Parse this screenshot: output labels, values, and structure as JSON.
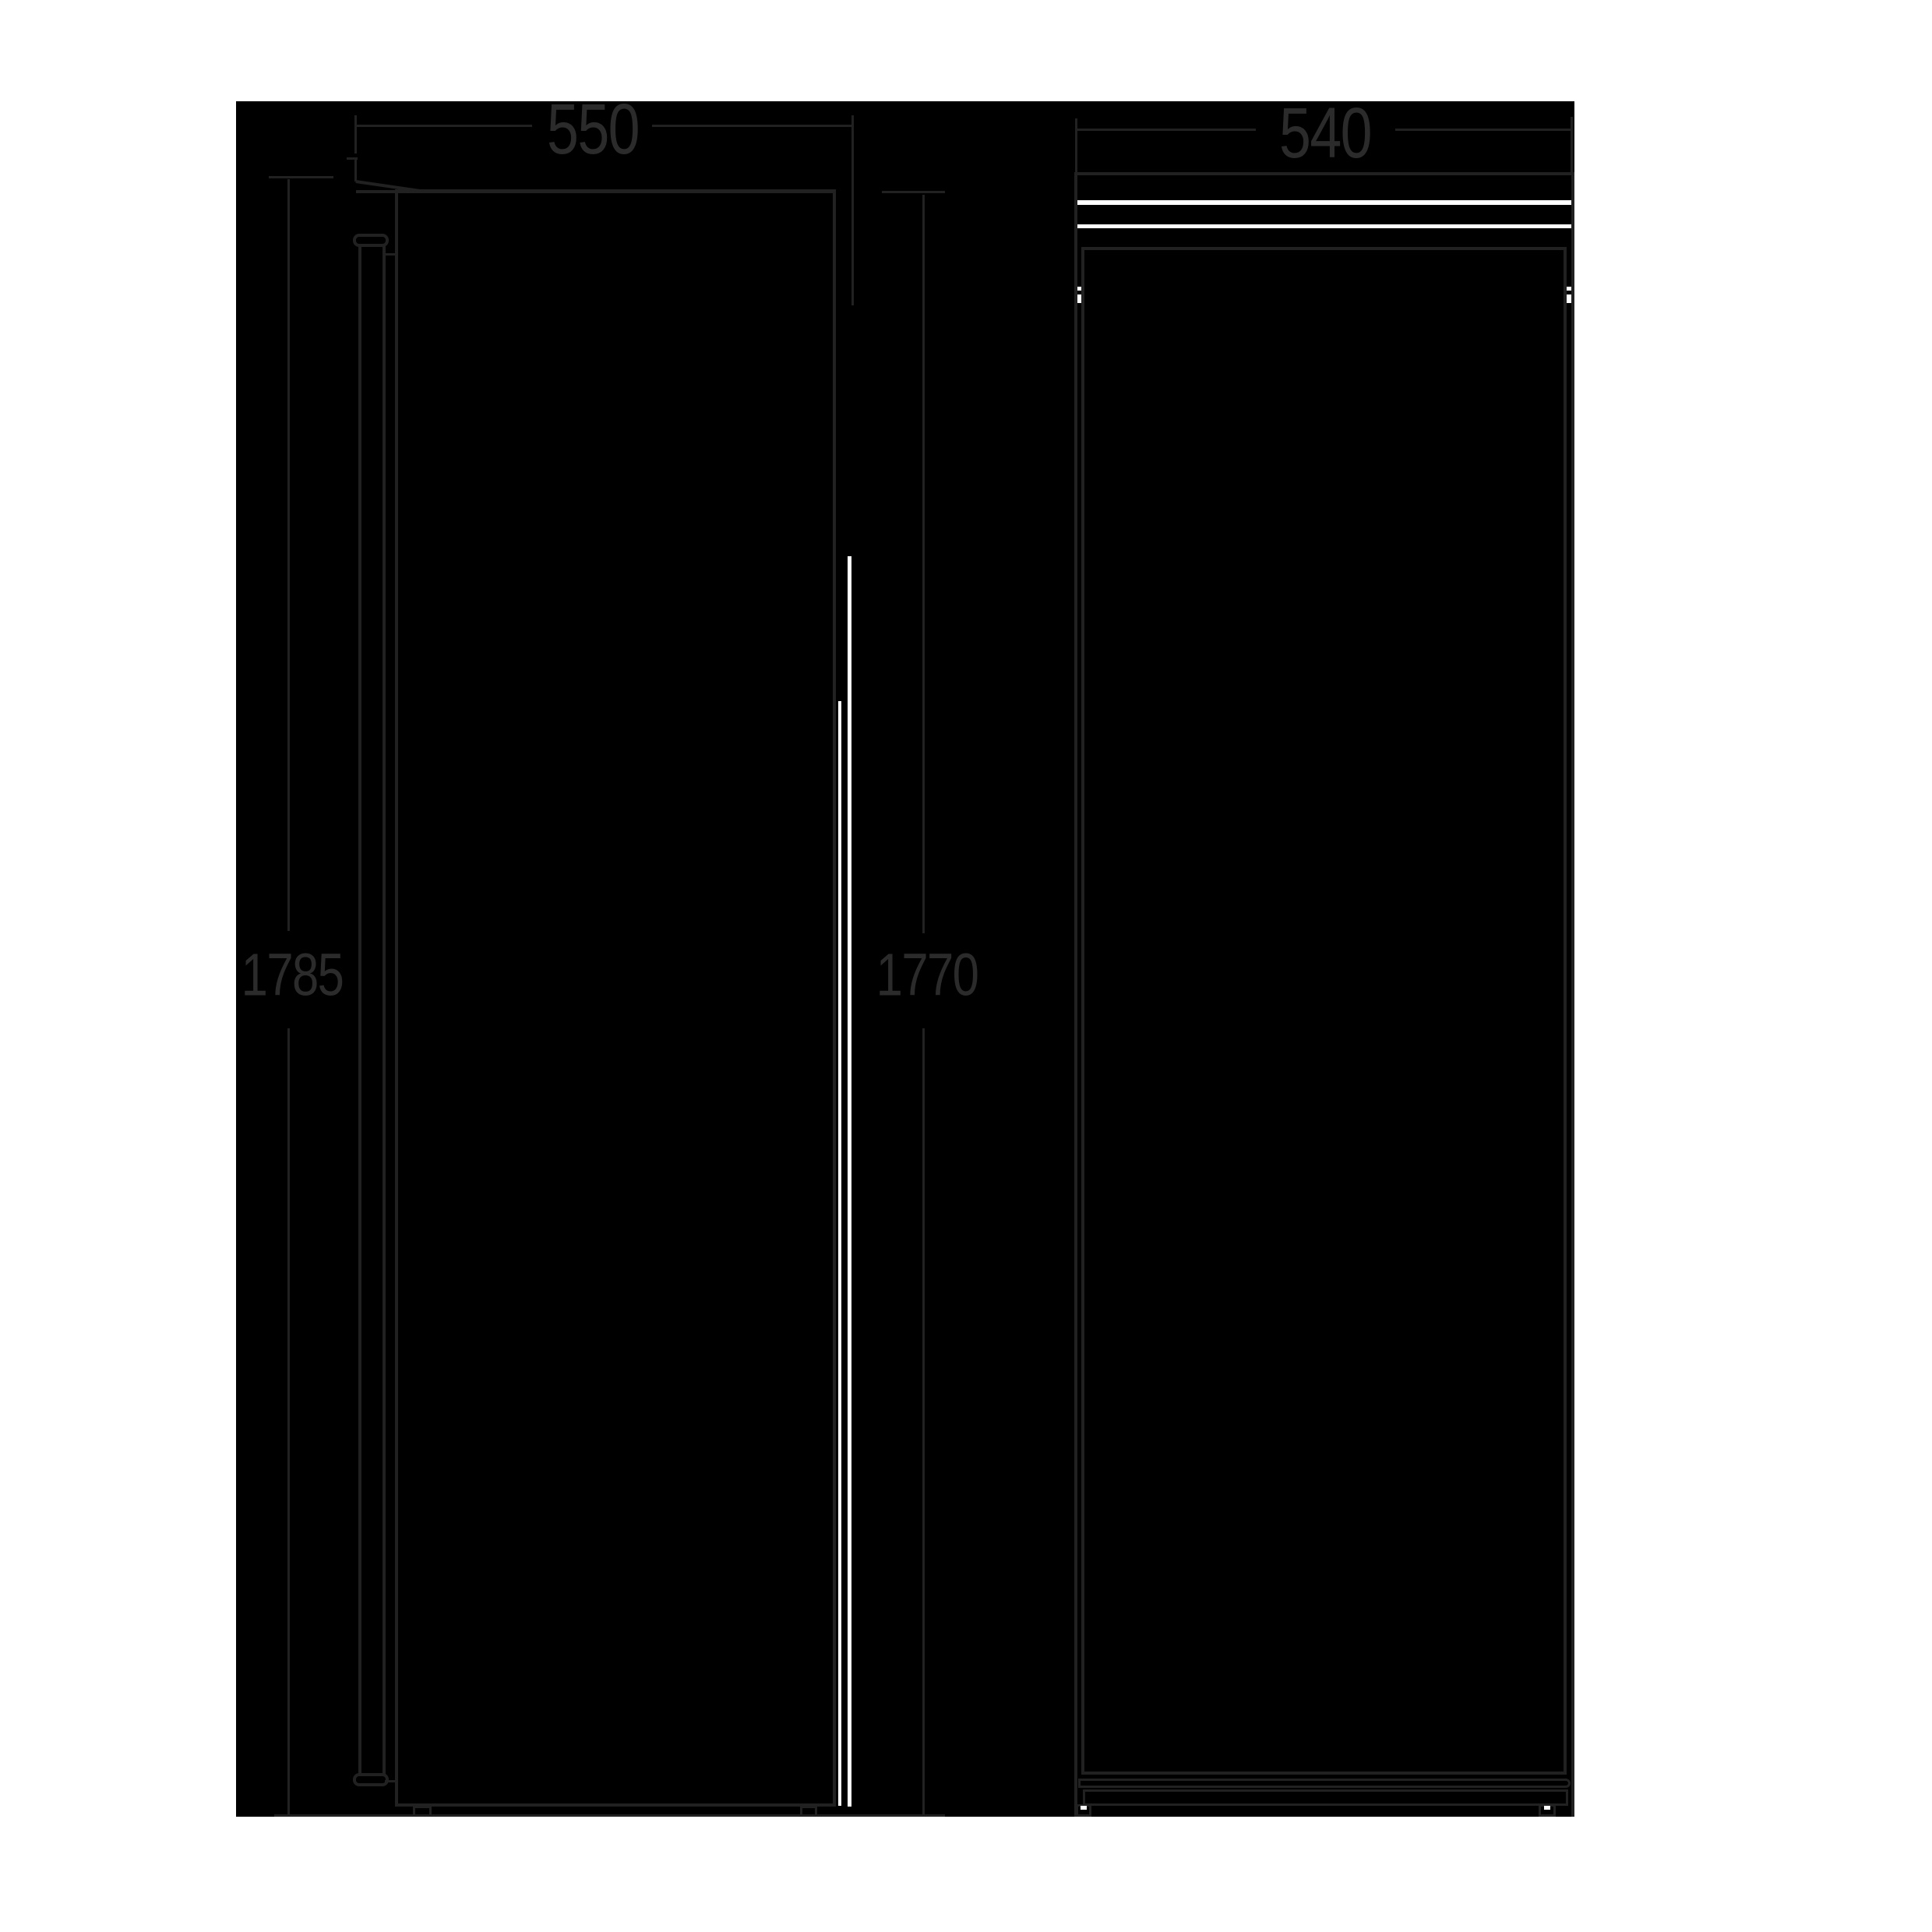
{
  "diagram": {
    "type": "appliance-dimension-drawing",
    "views": [
      {
        "name": "front-view",
        "description": "front elevation of upright appliance with bar handle"
      },
      {
        "name": "side-view",
        "description": "side elevation of upright appliance"
      }
    ]
  },
  "dimensions": {
    "front_width": "550",
    "cabinet_height": "1785",
    "door_height": "1770",
    "depth": "540"
  },
  "colors": {
    "page": "#ffffff",
    "canvas": "#000000",
    "ink": "#212121",
    "text": "#2b2b2b",
    "highlight": "#ffffff"
  }
}
